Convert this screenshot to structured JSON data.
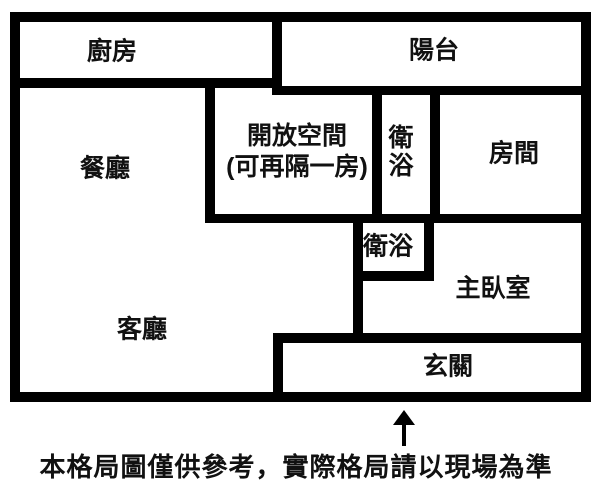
{
  "figure": {
    "type": "floor-plan",
    "background_color": "#ffffff",
    "wall_color": "#000000",
    "text_color": "#111111"
  },
  "rooms": {
    "kitchen": {
      "label": "廚房"
    },
    "balcony": {
      "label": "陽台"
    },
    "dining": {
      "label": "餐廳"
    },
    "open_space": {
      "label_line1": "開放空間",
      "label_line2": "(可再隔一房)"
    },
    "bathroom_top": {
      "label": "衛浴"
    },
    "bedroom": {
      "label": "房間"
    },
    "bathroom_mid": {
      "label": "衛浴"
    },
    "master_bedroom": {
      "label": "主臥室"
    },
    "living_room": {
      "label": "客廳"
    },
    "entry": {
      "label": "玄關"
    }
  },
  "annotations": {
    "entrance_arrow_symbol": "↑",
    "disclaimer": "本格局圖僅供參考，實際格局請以現場為準"
  }
}
